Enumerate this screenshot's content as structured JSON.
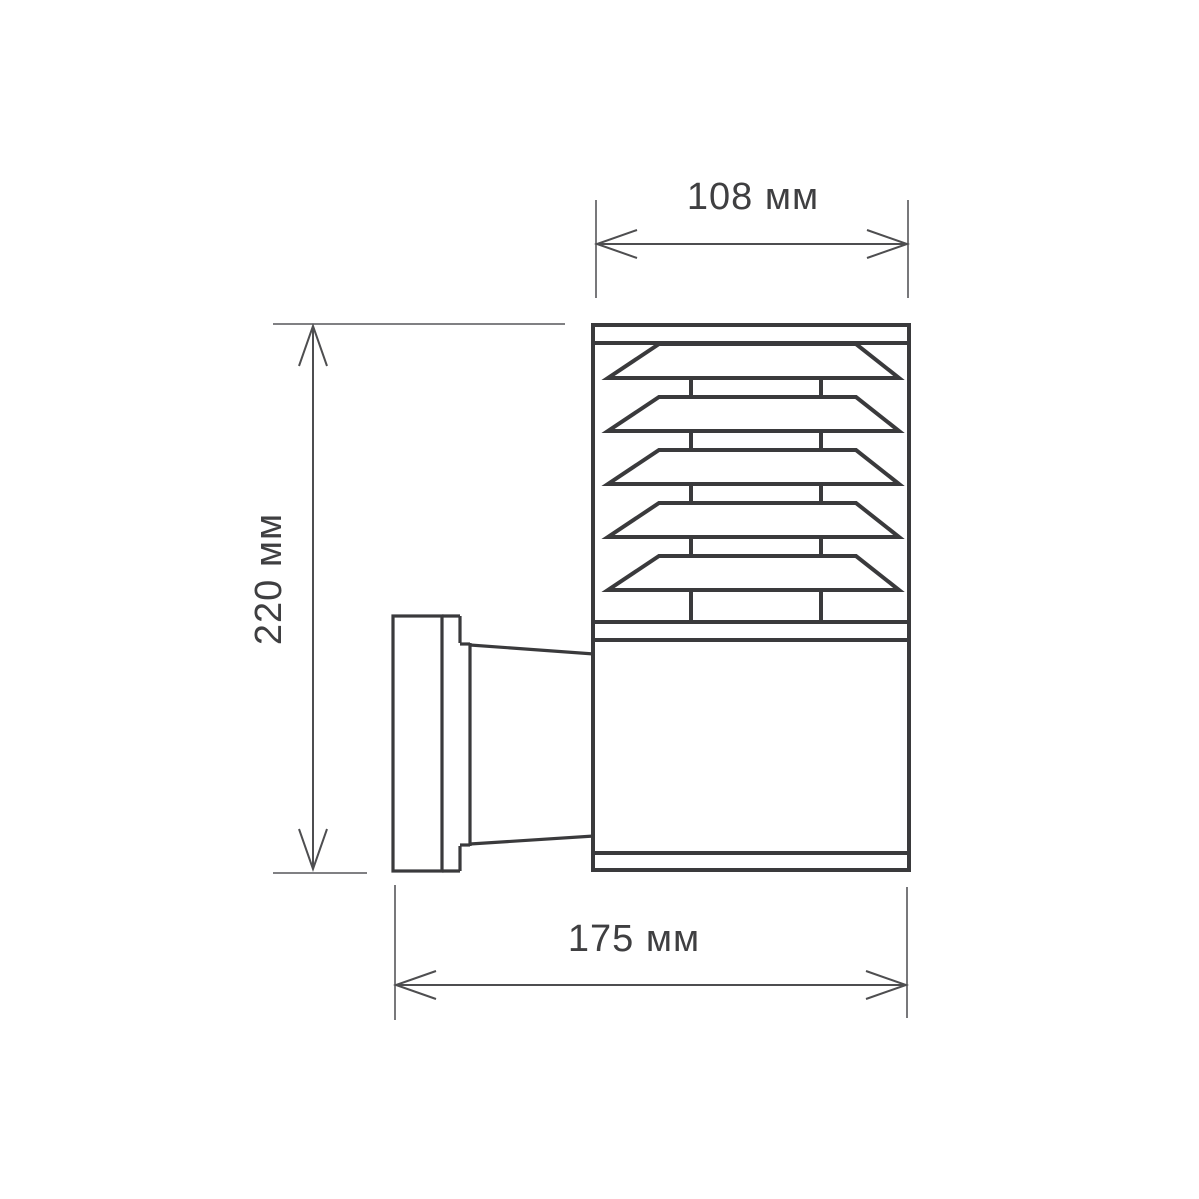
{
  "drawing": {
    "labels": {
      "width": "108 мм",
      "height": "220 мм",
      "depth": "175 мм"
    },
    "colors": {
      "background": "#ffffff",
      "outline": "#3a3a3c",
      "dimension_line": "#4e4e50",
      "text": "#3f3f41"
    }
  }
}
